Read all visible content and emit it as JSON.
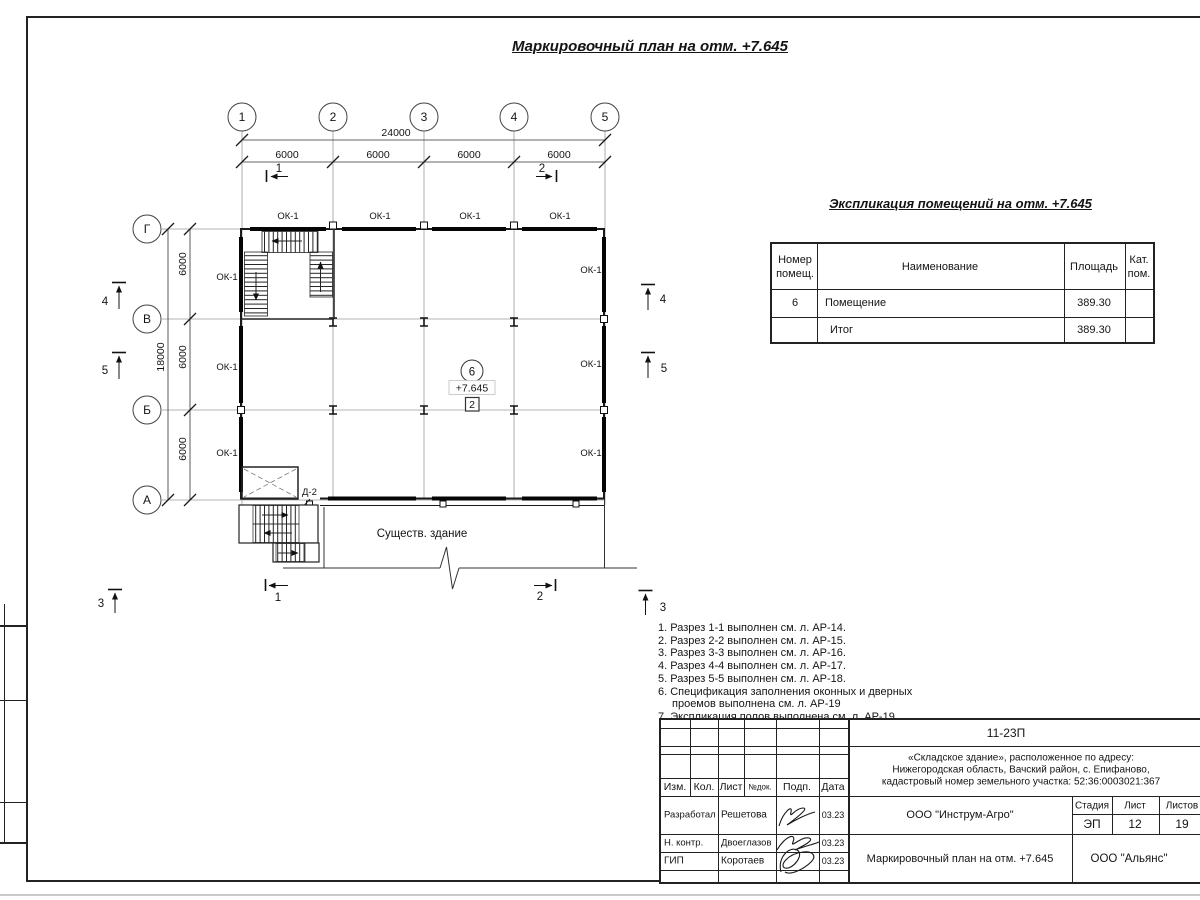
{
  "page": {
    "title": "Маркировочный план на отм. +7.645"
  },
  "plan": {
    "axis_cols": [
      "1",
      "2",
      "3",
      "4",
      "5"
    ],
    "axis_rows": [
      "Г",
      "В",
      "Б",
      "А"
    ],
    "dim_h_total": "24000",
    "dim_h": [
      "6000",
      "6000",
      "6000",
      "6000"
    ],
    "dim_v_total": "18000",
    "dim_v": [
      "6000",
      "6000",
      "6000"
    ],
    "window_mark": "ОК-1",
    "door_mark": "Д-2",
    "room_number": "6",
    "elevation_mark": "+7.645",
    "level_mark": "2",
    "existing_building_label": "Существ. здание",
    "sec1": "1",
    "sec2": "2",
    "sec3": "3",
    "sec4": "4",
    "sec5": "5"
  },
  "explication": {
    "title": "Экспликация помещений на отм. +7.645",
    "col_num_l1": "Номер",
    "col_num_l2": "помещ.",
    "col_name": "Наименование",
    "col_area": "Площадь",
    "col_cat_l1": "Кат.",
    "col_cat_l2": "пом.",
    "rows": [
      {
        "num": "6",
        "name": "Помещение",
        "area": "389.30",
        "cat": ""
      },
      {
        "num": "",
        "name": "Итог",
        "area": "389.30",
        "cat": ""
      }
    ]
  },
  "notes": {
    "l1": "1. Разрез 1-1 выполнен см. л. АР-14.",
    "l2": "2. Разрез 2-2 выполнен см. л. АР-15.",
    "l3": "3. Разрез 3-3 выполнен см. л. АР-16.",
    "l4": "4. Разрез 4-4 выполнен см. л. АР-17.",
    "l5": "5. Разрез 5-5 выполнен см. л. АР-18.",
    "l6a": "6. Спецификация заполнения оконных и дверных",
    "l6b": "проемов выполнена см. л. АР-19",
    "l7": "7. Экспликация полов выполнена см. л. АР-19."
  },
  "stamp": {
    "doc_number": "11-23П",
    "object_line1": "«Складское здание», расположенное по адресу:",
    "object_line2": "Нижегородская область, Вачский район, с. Епифаново,",
    "object_line3": "кадастровый номер земельного участка: 52:36:0003021:367",
    "col_izm": "Изм.",
    "col_kol": "Кол.",
    "col_list": "Лист",
    "col_ndok": "№док.",
    "col_podp": "Подп.",
    "col_data": "Дата",
    "row1_role": "Разработал",
    "row1_name": "Решетова",
    "row1_date": "03.23",
    "row2_role": "Н. контр.",
    "row2_name": "Двоеглазов",
    "row2_date": "03.23",
    "row3_role": "ГИП",
    "row3_name": "Коротаев",
    "row3_date": "03.23",
    "designer": "ООО \"Инструм-Агро\"",
    "stage_label": "Стадия",
    "list_label": "Лист",
    "listov_label": "Листов",
    "stage": "ЭП",
    "list": "12",
    "listov": "19",
    "drawing_title": "Маркировочный план на отм. +7.645",
    "org": "ООО \"Альянс\""
  }
}
